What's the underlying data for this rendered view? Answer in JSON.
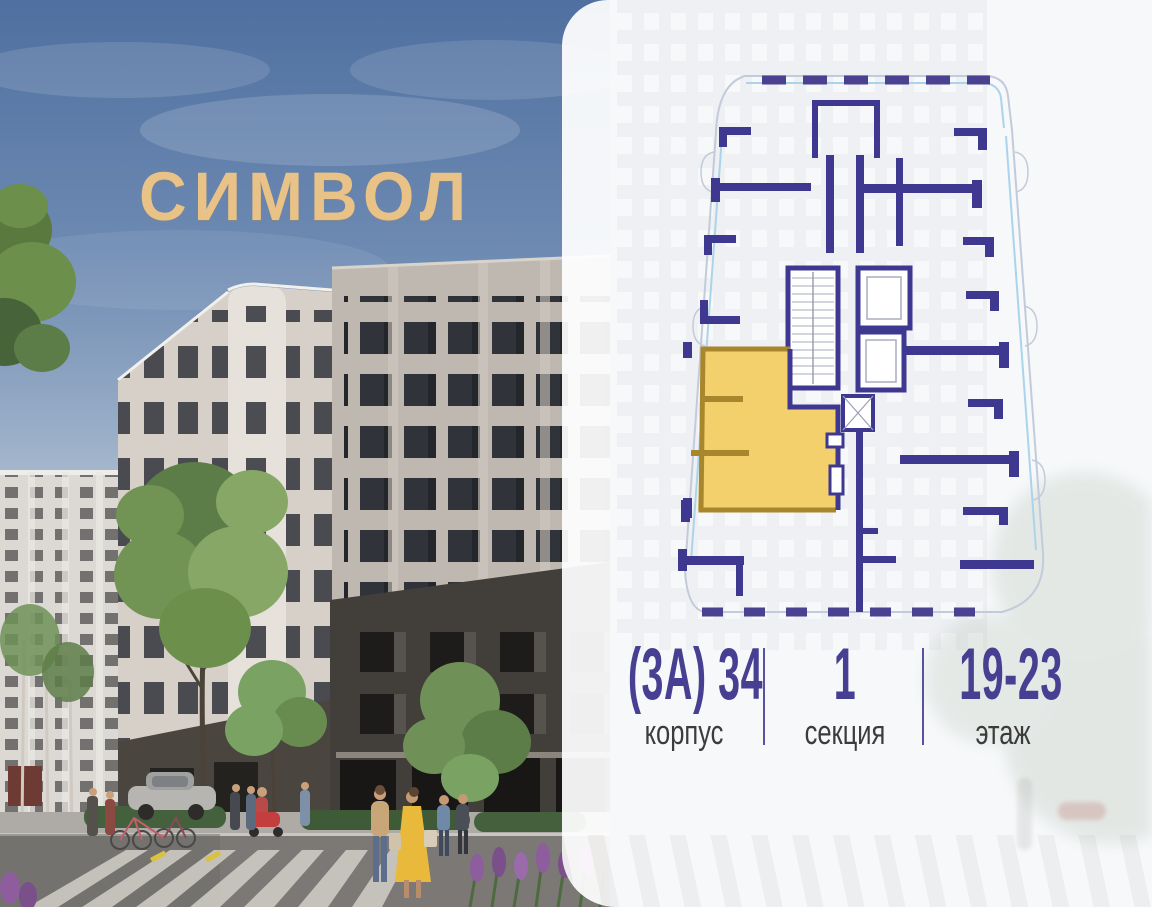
{
  "logo": {
    "text": "СИМВОЛ",
    "color": "#e9c287"
  },
  "card": {
    "stats": [
      {
        "value": "(3А) 34",
        "label": "корпус"
      },
      {
        "value": "1",
        "label": "секция"
      },
      {
        "value": "19-23",
        "label": "этаж"
      }
    ]
  },
  "floor_plan": {
    "highlight_color": "#f4d06d",
    "highlight_border_color": "#a8872c",
    "wall_color": "#3e3890",
    "glazing_color": "#abd4ea",
    "outline_color": "#c3cbda"
  },
  "colors": {
    "accent_purple": "#474092",
    "label_gray": "#3d3c3c",
    "logo_gold": "#e9c287",
    "card_background": "rgba(255,255,255,0.93)"
  }
}
